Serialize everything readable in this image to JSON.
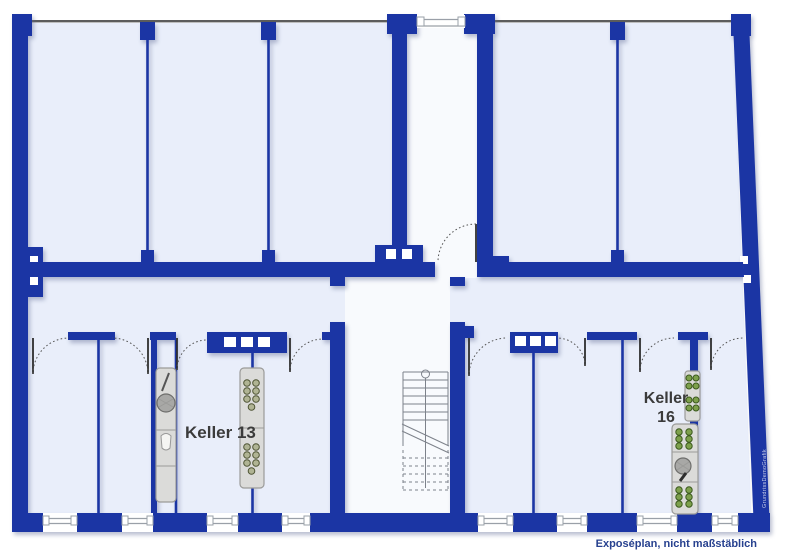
{
  "plan": {
    "title_note": "Exposéplan, nicht maßstäblich",
    "labels": {
      "compartment_13": "Keller 13",
      "compartment_16_line1": "Keller",
      "compartment_16_line2": "16"
    },
    "watermark": "GrundrissDemoGrafik",
    "icons": {
      "stairs": "staircase-icon",
      "doors": "door-swing-icon",
      "windows": "window-icon",
      "racket": "tennis-racket-icon",
      "bottles": "bottle-rack-icon",
      "vent_blocks": "vent-opening-icon"
    },
    "colors": {
      "wall": "#1b35a4",
      "room_fill": "#e9eefa",
      "stairwell_fill": "#f8fafd",
      "outline": "#5c5c5c",
      "window_line": "#9aa0a8",
      "furniture": "#dbdbd9",
      "furniture_border": "#9b9b99",
      "bottle_green": "#7da04c",
      "bottle_green_dark": "#3c5a1e",
      "gray_dot": "#b0b494",
      "gray_dot_dark": "#4e5434",
      "label_text": "#3b3b3b",
      "footer_text": "#27418f",
      "watermark": "#c9d0ea",
      "leaf": "#2e2e2e",
      "arc": "#555555",
      "stair": "#7d828b"
    }
  }
}
